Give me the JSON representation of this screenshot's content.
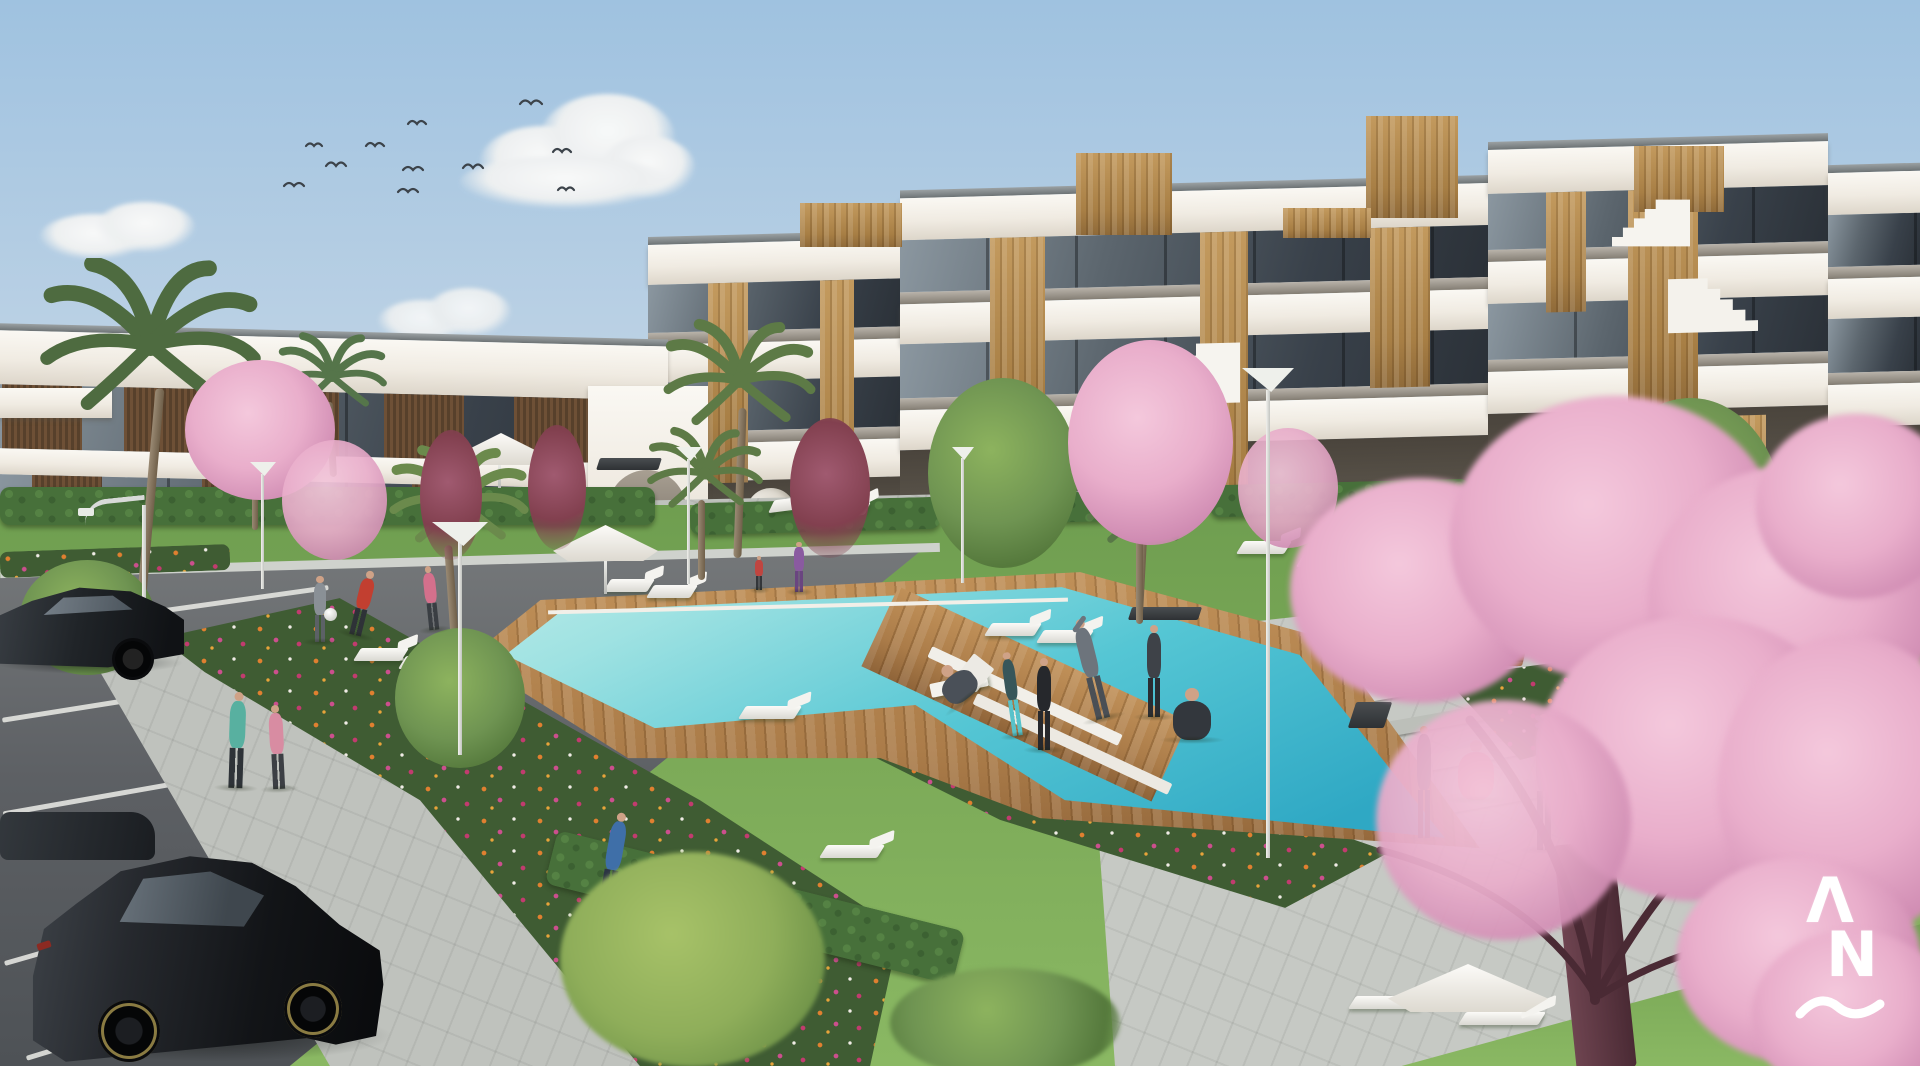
{
  "meta": {
    "type": "architectural-exterior-render",
    "subject": "Modern white low-rise apartment complex with communal pool garden, parking lot and people exercising",
    "conditions": "sunny day, clear light-blue sky"
  },
  "watermark": {
    "letter_top": "Λ",
    "letter_bottom": "N",
    "underline_shape": "wave"
  },
  "palette": {
    "sky_top": "#9fc2e0",
    "sky_horizon": "#e0e4e6",
    "building_white": "#f4f2ec",
    "glass_dark": "#39414a",
    "wood_light": "#c39a5e",
    "wood_slat_dark": "#57402b",
    "pool_light": "#9fe2e2",
    "pool_deep": "#2fa8c4",
    "deck_wood": "#ab7c49",
    "grass": "#7caa58",
    "hedge": "#47703a",
    "path_light": "#bfc2bd",
    "blossom_pink": "#e9aecb",
    "blossom_deep": "#cf8bb2",
    "flower_orange": "#e08030",
    "flower_magenta": "#cc4f8e",
    "flower_white": "#f0ece6",
    "car_black": "#17191c",
    "logo_white": "#ffffff"
  },
  "inventory": {
    "birds_in_sky": 11,
    "clouds": 6,
    "buildings": {
      "left_wing_floors": 2,
      "right_wing_floors": 3,
      "facade": "white slabs with oak wood panels, dark glass balconies, gray glass balustrades",
      "rooftop_wood_towers": 5,
      "external_staircases": 3,
      "arched_passages": 2
    },
    "pool": {
      "water_color": "turquoise",
      "deck": "wooden with white crossing planks",
      "shape": "L-shaped"
    },
    "sun_loungers": 14,
    "parasols": 3,
    "benches": 4,
    "street_lamps": 7,
    "palm_trees": 6,
    "cherry_blossom_trees": 7,
    "green_trees": 4,
    "flower_beds": 5,
    "cars": 3,
    "people": {
      "count": 19,
      "activities": [
        "jogging",
        "cycling",
        "stretching",
        "yoga",
        "playing with a ball",
        "sitting on bench",
        "lounging in deck chair",
        "walking"
      ]
    }
  }
}
